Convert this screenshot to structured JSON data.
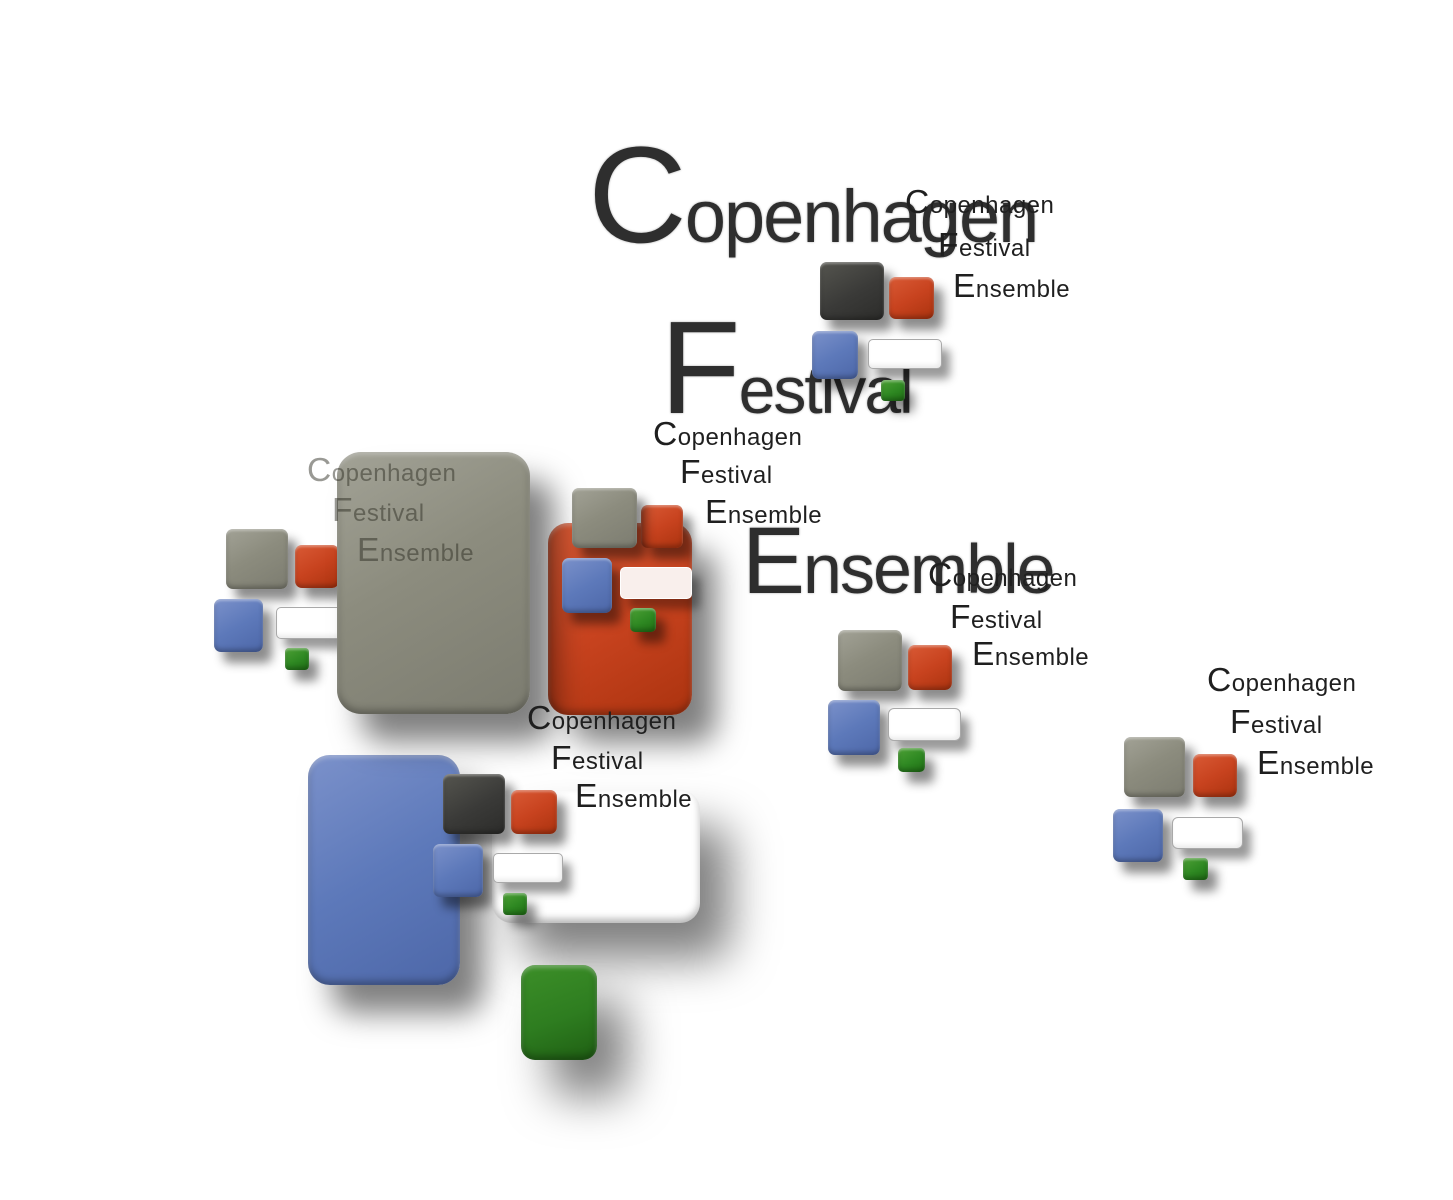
{
  "words": {
    "copenhagen": "Copenhagen",
    "festival": "Festival",
    "ensemble": "Ensemble"
  },
  "colors": {
    "background": "#ffffff",
    "olive_gray": "#8c8c7e",
    "vermillion_red": "#c8431f",
    "blue": "#5d79ba",
    "charcoal": "#3a3a38",
    "green": "#2e8822",
    "dark_green": "#2e7d20",
    "white_tile": "#ffffff",
    "pink_white_tile": "#f9efec",
    "title_text": "#2e2e2e",
    "label_text": "#1f1f1f",
    "muted_label_text": "#70706a"
  }
}
